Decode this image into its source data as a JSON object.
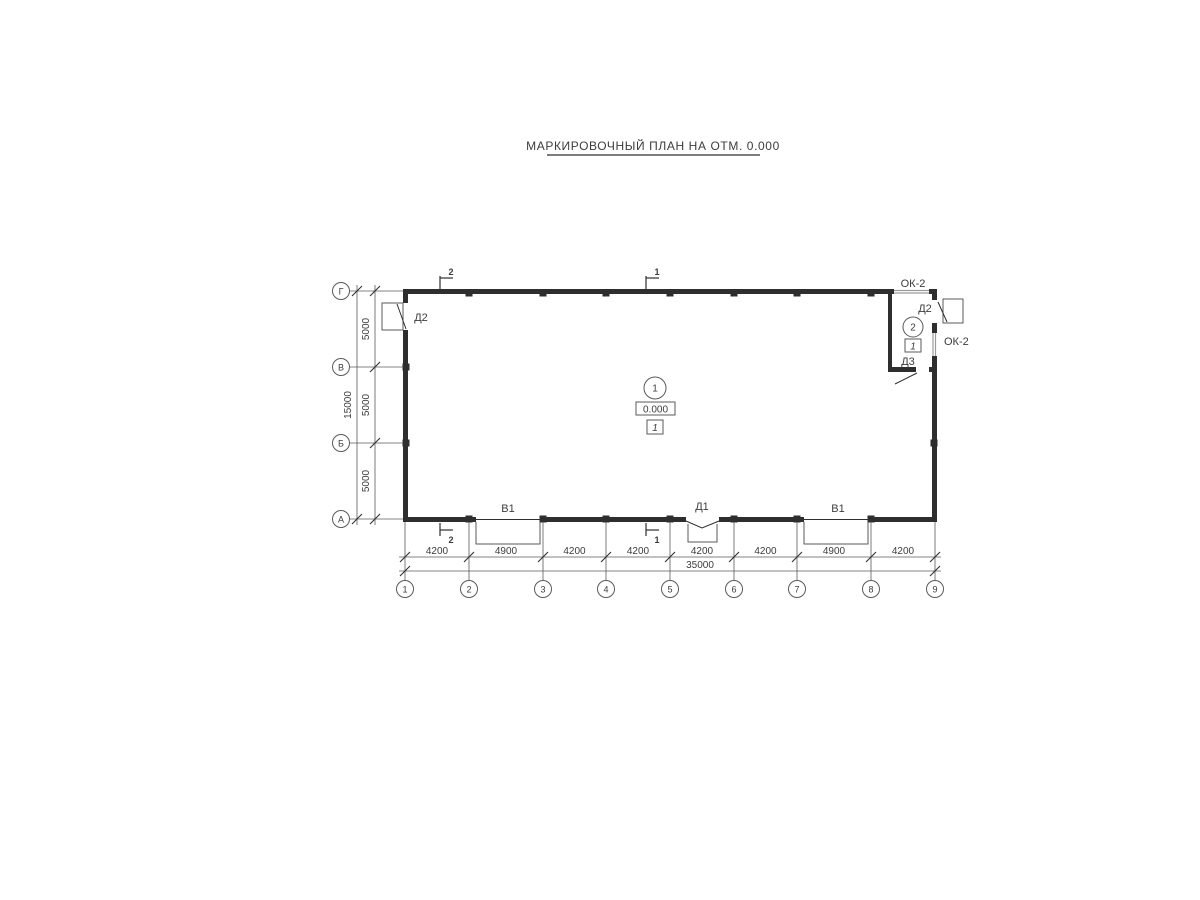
{
  "colors": {
    "background": "#ffffff",
    "ink": "#2e2e2e",
    "thin_line": "#5a5a5a",
    "window_line": "#9c9c9c",
    "text": "#3c3c3c"
  },
  "title": {
    "text": "МАРКИРОВОЧНЫЙ ПЛАН НА ОТМ. 0.000"
  },
  "axes": {
    "columns": [
      "1",
      "2",
      "3",
      "4",
      "5",
      "6",
      "7",
      "8",
      "9"
    ],
    "rows": [
      "Г",
      "В",
      "Б",
      "А"
    ]
  },
  "dimensions": {
    "bottom": {
      "segments": [
        "4200",
        "4900",
        "4200",
        "4200",
        "4200",
        "4200",
        "4900",
        "4200"
      ],
      "total": "35000"
    },
    "left": {
      "segments": [
        "5000",
        "5000",
        "5000"
      ],
      "total": "15000"
    }
  },
  "openings": {
    "door_left": "Д2",
    "door_right": "Д2",
    "door_d3": "Д3",
    "door_d1": "Д1",
    "gate_left": "В1",
    "gate_right": "В1",
    "window_top": "ОК-2",
    "window_right": "ОК-2"
  },
  "rooms": {
    "main": {
      "number": "1",
      "elevation": "0.000",
      "category": "1"
    },
    "small": {
      "number": "2",
      "category": "1"
    }
  },
  "sections": {
    "mark_1": "1",
    "mark_2": "2"
  }
}
